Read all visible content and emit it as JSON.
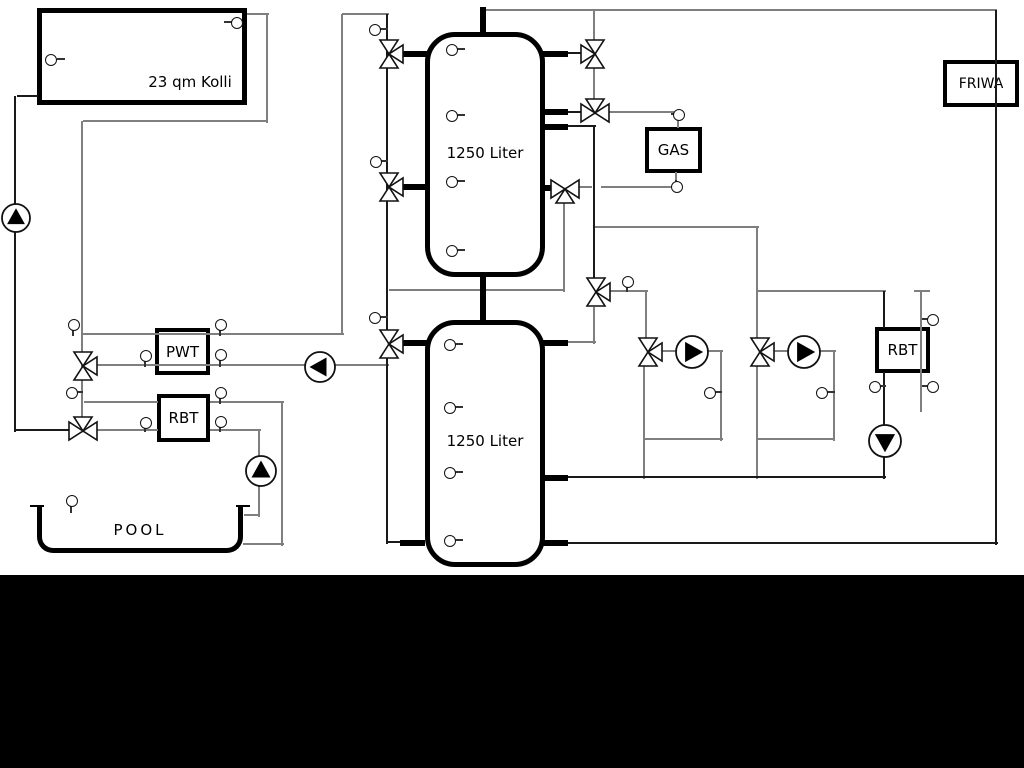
{
  "labels": {
    "collector": "23 qm Kolli",
    "tank1": "1250 Liter",
    "tank2": "1250 Liter",
    "pwt": "PWT",
    "rbt_left": "RBT",
    "pool": "POOL",
    "gas": "GAS",
    "friwa": "FRIWA",
    "rbt_right": "RBT"
  },
  "colors": {
    "background": "#ffffff",
    "pipe_gray": "#7f7f7f",
    "pipe_dark": "#1a1a1a",
    "component_black": "#000000",
    "footer_band": "#000000"
  }
}
